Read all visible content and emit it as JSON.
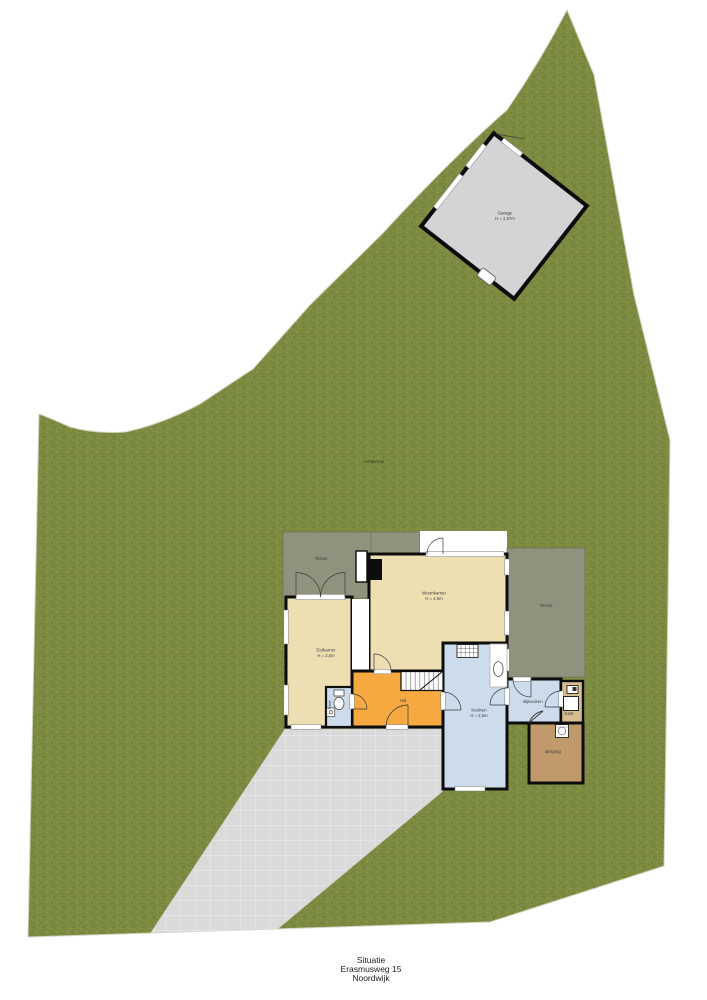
{
  "caption": {
    "line1": "Situatie",
    "line2": "Erasmusweg 15",
    "line3": "Noordwijk"
  },
  "garden": {
    "label": "Achtertuin"
  },
  "garage": {
    "name": "Garage",
    "height": "H = 2,57m"
  },
  "terraces": {
    "left": "Terras",
    "right": "Terras"
  },
  "rooms": {
    "woonkamer": {
      "name": "Woonkamer",
      "height": "H = 4,0m"
    },
    "eetkamer": {
      "name": "Eetkamer",
      "height": "H = 2,5m"
    },
    "keuken": {
      "name": "Keuken",
      "height": "H = 2,6m"
    },
    "hal": {
      "name": "Hal"
    },
    "toilet": {
      "name": "Toilet"
    },
    "bijkeuken": {
      "name": "Bijkeuken"
    },
    "kast": {
      "name": "Kast"
    },
    "berging": {
      "name": "Berging"
    }
  },
  "colors": {
    "grass": "#7c8b41",
    "terrace": "#90927e",
    "driveway": "#d9d9d9",
    "garage_floor": "#d3d4d6",
    "room_tan": "#eedfb3",
    "room_orange": "#f7a941",
    "room_blue": "#ccdcec",
    "room_brown": "#c19a6b",
    "kast_tan": "#d9bd92",
    "walls": "#0d0d0d",
    "background": "#ffffff"
  }
}
